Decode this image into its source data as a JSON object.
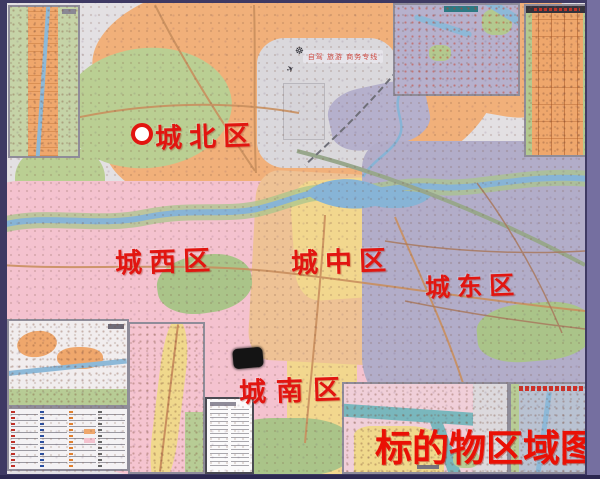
{
  "page": {
    "title_label": "标的物区域图"
  },
  "route_banner": {
    "text": "自驾 旅游 商务专线"
  },
  "districts": [
    {
      "name": "north",
      "label": "城北区",
      "marker": "white-circle-red-ring"
    },
    {
      "name": "west",
      "label": "城西区",
      "marker": "none"
    },
    {
      "name": "central",
      "label": "城中区",
      "marker": "none"
    },
    {
      "name": "east",
      "label": "城东区",
      "marker": "none"
    },
    {
      "name": "south",
      "label": "城南区",
      "marker": "black-rounded-rectangle"
    }
  ],
  "icons": [
    {
      "name": "steering-wheel-icon",
      "glyph": "☸"
    },
    {
      "name": "plane-icon",
      "glyph": "✈"
    }
  ],
  "colors": {
    "frame": "#3e3963",
    "paper": "#e3e0e3",
    "north_orange": "#f1b07a",
    "west_pink": "#f4c2cf",
    "central_yellow": "#f2d78e",
    "east_lavender": "#b2adc9",
    "park_green": "#aac489",
    "river_blue": "#87b4d6",
    "district_label_red": "#e21510",
    "title_red": "#ea1005"
  }
}
